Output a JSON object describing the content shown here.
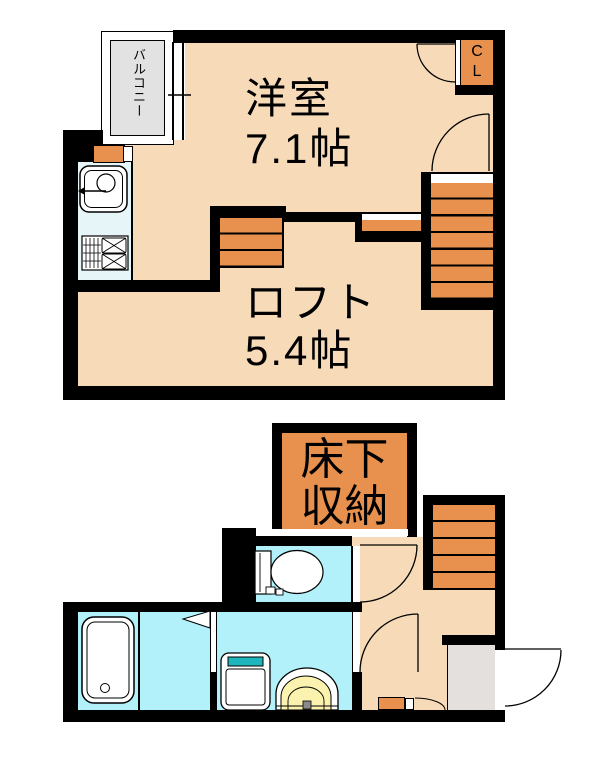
{
  "upper_floor": {
    "balcony_label": "バルコニー",
    "room_name": "洋室",
    "room_size": "7.1帖",
    "loft_name": "ロフト",
    "loft_size": "5.4帖",
    "closet_line1": "C",
    "closet_line2": "L"
  },
  "lower_floor": {
    "storage_line1": "床下",
    "storage_line2": "収納"
  },
  "colors": {
    "floor": "#F7DBB8",
    "accent_orange": "#E8914E",
    "kitchen": "#E6F6F8",
    "bath": "#B2F1FA",
    "balcony_gray": "#E2E2E2",
    "entrance_gray": "#E3E0DD",
    "basin_yellow": "#FAF2AE",
    "washer_teal": "#1FB5BD",
    "wall": "#000000"
  }
}
